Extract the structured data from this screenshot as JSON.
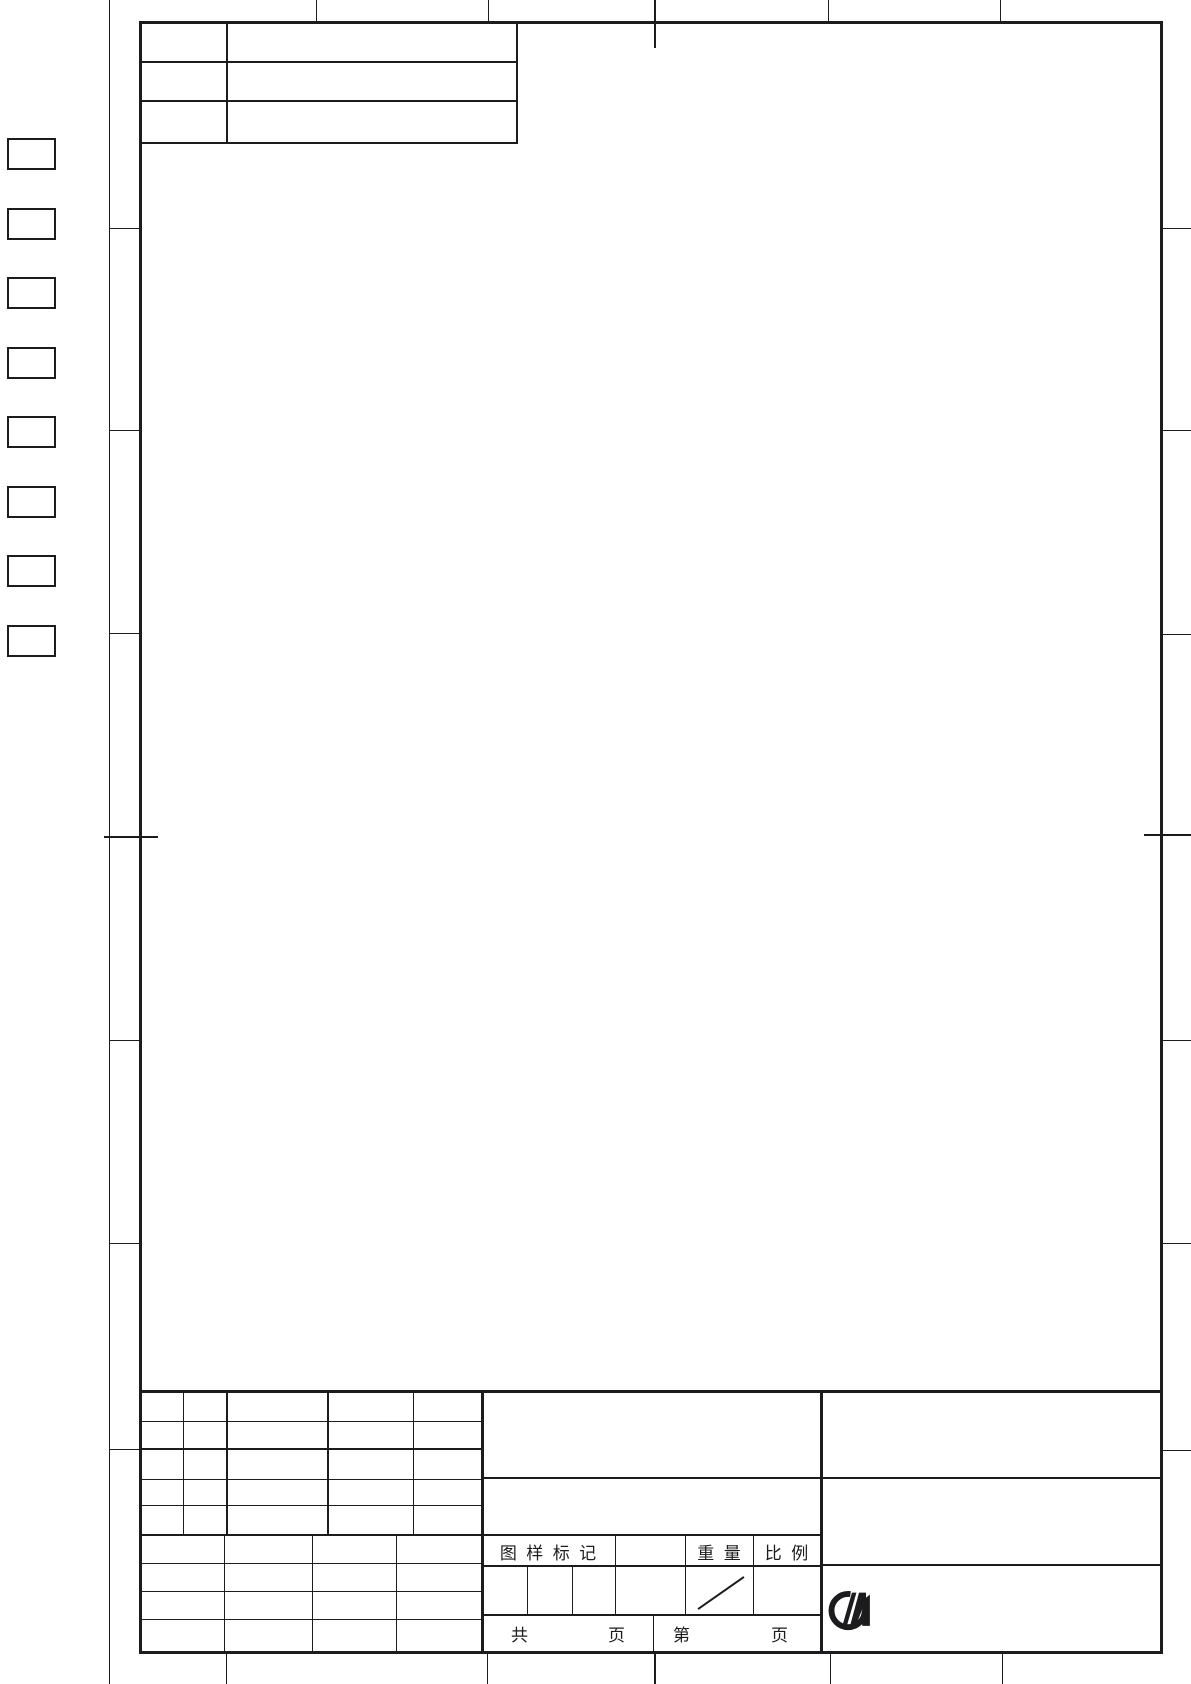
{
  "page": {
    "background": "#ffffff",
    "line_color": "#1c1c1e"
  },
  "title_block": {
    "drawing_mark_label": "图 样 标 记",
    "weight_label": "重 量",
    "scale_label": "比 例",
    "total_prefix": "共",
    "total_suffix": "页",
    "page_prefix": "第",
    "page_suffix": "页"
  },
  "logo": {
    "icon": "midea-logo"
  }
}
